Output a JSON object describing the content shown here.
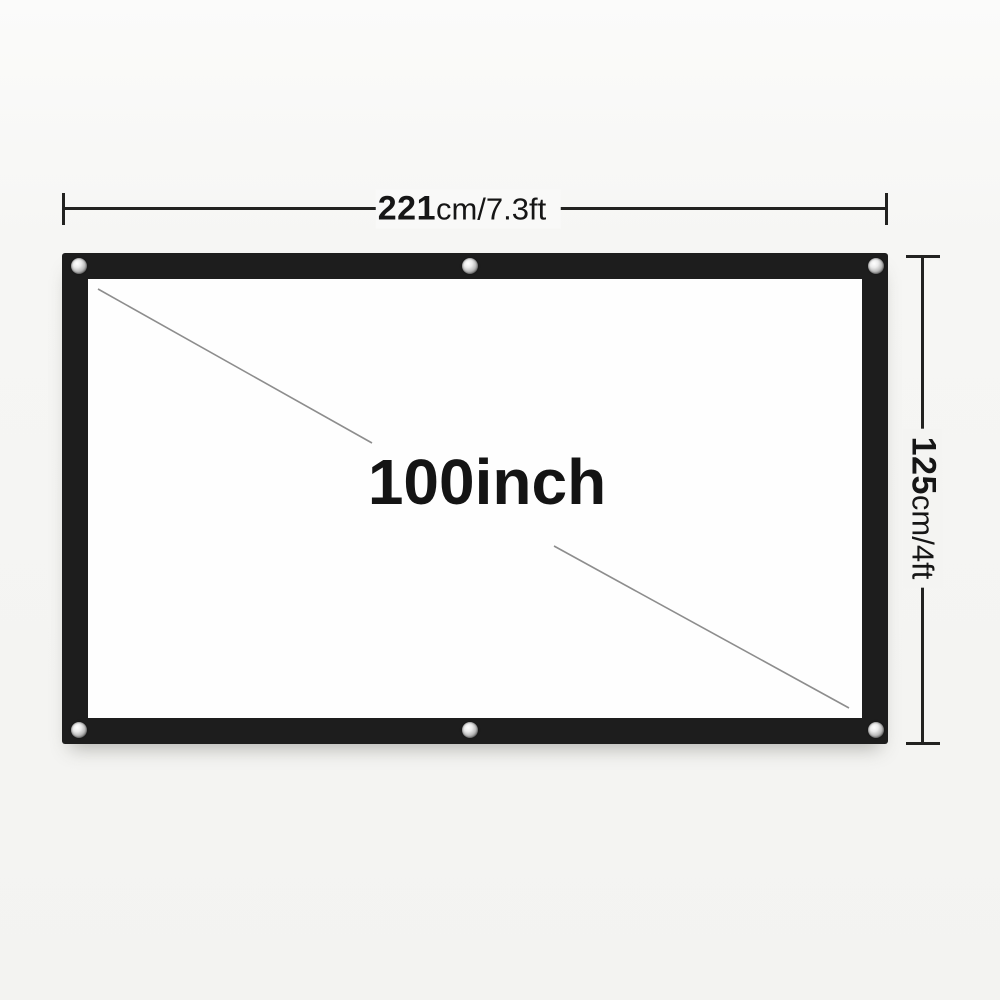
{
  "diagram": {
    "size_label": "100inch",
    "width": {
      "value": "221",
      "unit": "cm/7.3ft"
    },
    "height": {
      "value": "125",
      "unit": "cm/4ft"
    },
    "grommet_count": 6
  },
  "colors": {
    "background": "#f5f5f3",
    "frame": "#1d1d1d",
    "screen_surface": "#fefefe",
    "dimension_line": "#222220",
    "diagonal_line": "#8d8d8d",
    "text": "#161616"
  }
}
